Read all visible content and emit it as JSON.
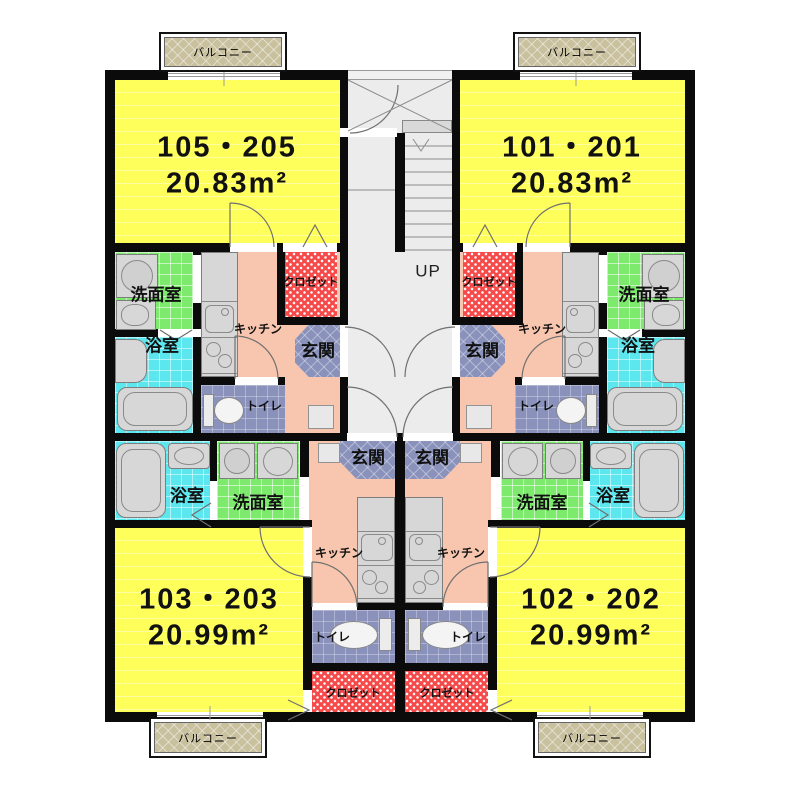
{
  "units": [
    {
      "name": "105・205",
      "area": "20.83m²"
    },
    {
      "name": "101・201",
      "area": "20.83m²"
    },
    {
      "name": "103・203",
      "area": "20.99m²"
    },
    {
      "name": "102・202",
      "area": "20.99m²"
    }
  ],
  "labels": {
    "balcony": "バルコニー",
    "up": "UP",
    "washroom": "洗面室",
    "bath": "浴室",
    "kitchen": "キッチン",
    "closet": "クロゼット",
    "entrance": "玄関",
    "toilet": "トイレ"
  },
  "colors": {
    "room": "#ffff5c",
    "room_stripe": "#ffffa0",
    "balcony": "#c9c09e",
    "washroom": "#7de96d",
    "bath": "#5ce7ef",
    "kitchen_floor": "#f8c6ae",
    "entrance_toilet": "#8a92bc",
    "closet": "#f64a4a",
    "corridor": "#ececec",
    "wall": "#0b0b0b",
    "fixture": "#d7d7d7"
  }
}
